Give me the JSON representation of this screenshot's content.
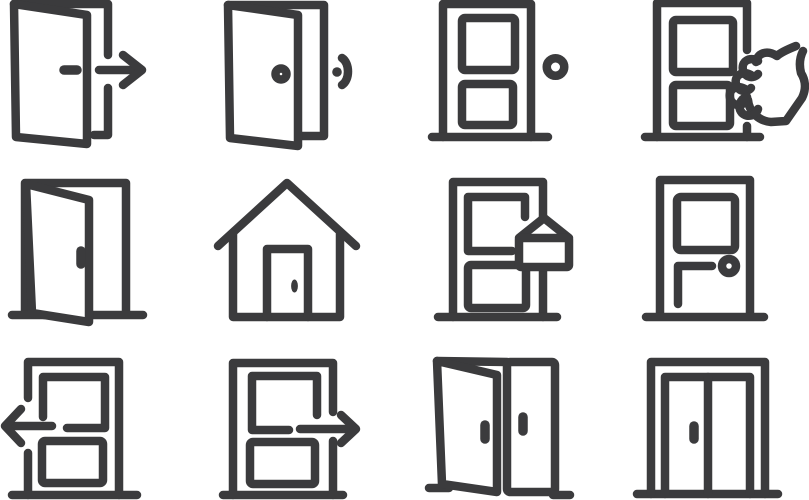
{
  "colors": {
    "stroke": "#3b3b3d",
    "background": "#ffffff"
  },
  "icons": [
    {
      "name": "door-exit-arrow-right-icon",
      "label": "Open door with exit arrow pointing right"
    },
    {
      "name": "door-open-doorbell-icon",
      "label": "Open door with doorbell sound wave"
    },
    {
      "name": "door-closed-doorbell-icon",
      "label": "Closed panel door with doorbell button"
    },
    {
      "name": "door-knocking-hand-icon",
      "label": "Hand knocking on panel door"
    },
    {
      "name": "door-open-icon",
      "label": "Open door in frame"
    },
    {
      "name": "home-icon",
      "label": "House with front door"
    },
    {
      "name": "door-hanger-sign-icon",
      "label": "Panel door with hanging sign"
    },
    {
      "name": "door-window-handle-icon",
      "label": "Door with window, push handle and knob"
    },
    {
      "name": "door-arrow-left-icon",
      "label": "Panel door with arrow pointing left"
    },
    {
      "name": "door-arrow-right-icon",
      "label": "Panel door with arrow pointing right"
    },
    {
      "name": "double-door-one-open-icon",
      "label": "Double door with left leaf open"
    },
    {
      "name": "double-door-closed-icon",
      "label": "Closed double door"
    }
  ]
}
